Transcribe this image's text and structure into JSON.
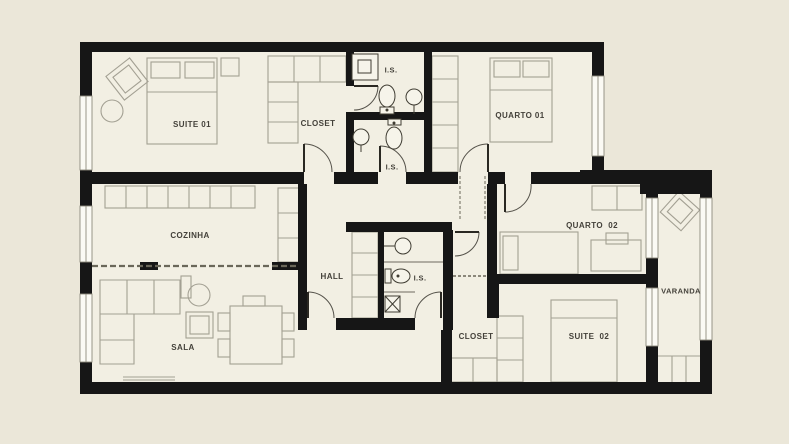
{
  "plan": {
    "rooms": {
      "suite01": "SUITE 01",
      "closetTop": "CLOSET",
      "isTop": "I.S.",
      "isMid": "I.S.",
      "quarto01": "QUARTO 01",
      "cozinha": "COZINHA",
      "hall": "HALL",
      "isCentral": "I.S.",
      "quarto02": "QUARTO  02",
      "varanda": "VARANDA",
      "sala": "SALA",
      "closetBottom": "CLOSET",
      "suite02": "SUITE  02"
    },
    "colors": {
      "background": "#ebe7d9",
      "floor": "#f2efe3",
      "wall": "#161616",
      "window_fill": "#fbfaf4",
      "furniture_line": "#a3a093",
      "fixture_line": "#403d33",
      "label_text": "#44413a"
    }
  }
}
